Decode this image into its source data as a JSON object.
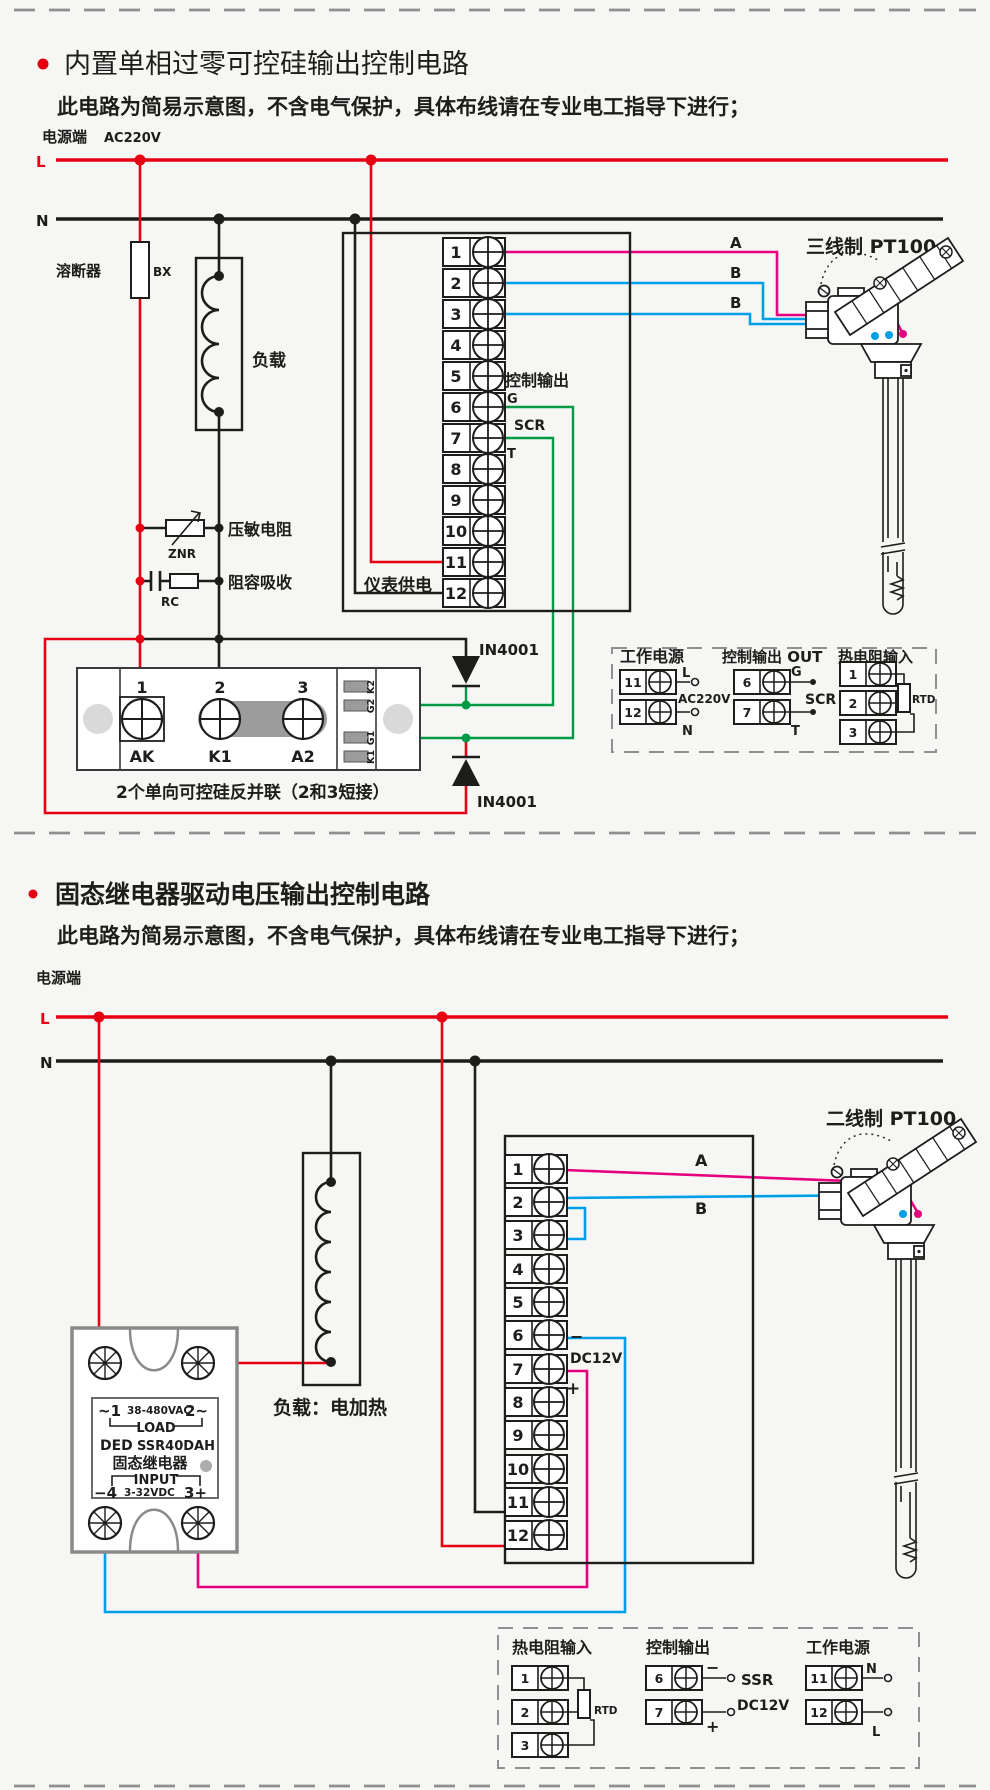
{
  "d1": {
    "title": "内置单相过零可控硅输出控制电路",
    "subtitle": "此电路为简易示意图，不含电气保护，具体布线请在专业电工指导下进行；",
    "power_label": "电源端",
    "voltage": "AC220V",
    "l": "L",
    "n": "N",
    "fuse": "溶断器",
    "fuse_code": "BX",
    "load": "负载",
    "varistor": "压敏电阻",
    "varistor_code": "ZNR",
    "rc": "阻容吸收",
    "rc_code": "RC",
    "meter_power": "仪表供电",
    "ctrl_out": "控制输出",
    "g": "G",
    "scr": "SCR",
    "t": "T",
    "diode": "IN4001",
    "sensor": "三线制 PT100",
    "wa": "A",
    "wb1": "B",
    "wb2": "B",
    "terminals": [
      "1",
      "2",
      "3",
      "4",
      "5",
      "6",
      "7",
      "8",
      "9",
      "10",
      "11",
      "12"
    ],
    "module": {
      "n1": "1",
      "n2": "2",
      "n3": "3",
      "l1": "AK",
      "l2": "K1",
      "l3": "A2",
      "t1": "K2",
      "t2": "G2",
      "t3": "G1",
      "t4": "K1",
      "caption": "2个单向可控硅反并联（2和3短接）"
    },
    "legend": {
      "power_title": "工作电源",
      "power_n11": "11",
      "power_n12": "12",
      "power_l": "L",
      "power_n": "N",
      "power_v": "AC220V",
      "out_title": "控制输出 OUT",
      "out_n6": "6",
      "out_n7": "7",
      "out_g": "G",
      "out_t": "T",
      "out_dev": "SCR",
      "rtd_title": "热电阻输入",
      "rtd_n1": "1",
      "rtd_n2": "2",
      "rtd_n3": "3",
      "rtd_dev": "RTD"
    }
  },
  "d2": {
    "title": "固态继电器驱动电压输出控制电路",
    "subtitle": "此电路为简易示意图，不含电气保护，具体布线请在专业电工指导下进行；",
    "power_label": "电源端",
    "l": "L",
    "n": "N",
    "load": "负载：电加热",
    "sensor": "二线制 PT100",
    "wa": "A",
    "wb": "B",
    "minus": "−",
    "plus": "+",
    "dc12v": "DC12V",
    "terminals": [
      "1",
      "2",
      "3",
      "4",
      "5",
      "6",
      "7",
      "8",
      "9",
      "10",
      "11",
      "12"
    ],
    "ssr": {
      "ac1": "~1",
      "acv": "38-480VAC",
      "ac2": "2~",
      "load": "LOAD",
      "brand": "DED",
      "model": "SSR40DAH",
      "name": "固态继电器",
      "input": "INPUT",
      "dc_m": "−4",
      "dcv": "3-32VDC",
      "dc_p": "3+"
    },
    "legend": {
      "rtd_title": "热电阻输入",
      "rtd_n1": "1",
      "rtd_n2": "2",
      "rtd_n3": "3",
      "rtd_dev": "RTD",
      "out_title": "控制输出",
      "out_n6": "6",
      "out_n7": "7",
      "out_m": "−",
      "out_p": "+",
      "out_dev": "SSR",
      "out_v": "DC12V",
      "power_title": "工作电源",
      "power_n11": "11",
      "power_n12": "12",
      "power_n": "N",
      "power_l": "L"
    }
  }
}
